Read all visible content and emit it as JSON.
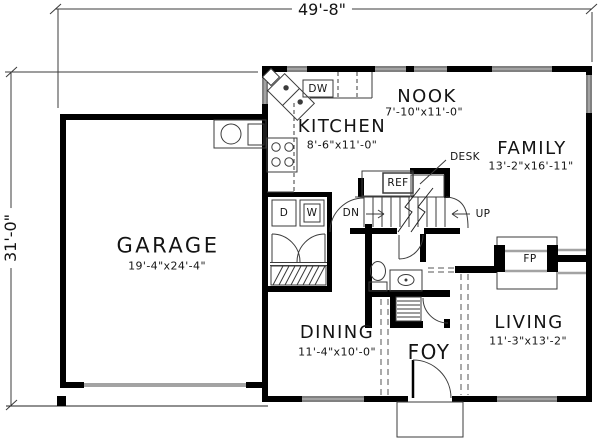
{
  "dimensions": {
    "overall_width": "49'-8\"",
    "overall_depth": "31'-0\""
  },
  "rooms": {
    "garage": {
      "name": "GARAGE",
      "size": "19'-4\"x24'-4\""
    },
    "kitchen": {
      "name": "KITCHEN",
      "size": "8'-6\"x11'-0\""
    },
    "nook": {
      "name": "NOOK",
      "size": "7'-10\"x11'-0\""
    },
    "family": {
      "name": "FAMILY",
      "size": "13'-2\"x16'-11\""
    },
    "dining": {
      "name": "DINING",
      "size": "11'-4\"x10'-0\""
    },
    "living": {
      "name": "LIVING",
      "size": "11'-3\"x13'-2\""
    },
    "foyer": {
      "name": "FOY"
    }
  },
  "fixtures": {
    "dishwasher": "DW",
    "dryer": "D",
    "washer": "W",
    "refrigerator": "REF",
    "desk": "DESK",
    "fireplace": "FP",
    "stairs_down": "DN",
    "stairs_up": "UP"
  },
  "colors": {
    "wall": "#000000",
    "thin_line": "#3b3b3b",
    "light_gray": "#a3a3a3",
    "background": "#ffffff"
  }
}
